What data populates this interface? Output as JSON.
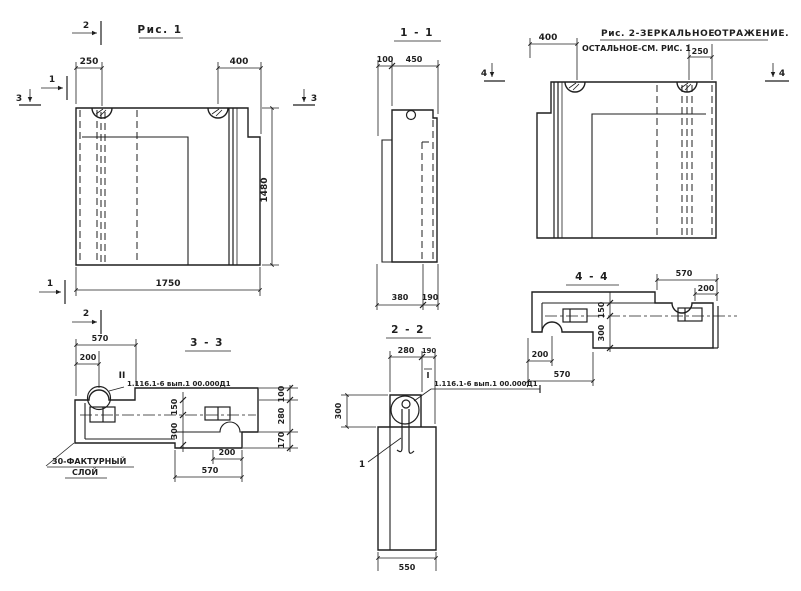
{
  "fig1": {
    "title": "Рис. 1",
    "dim_250": "250",
    "dim_400": "400",
    "dim_1480": "1480",
    "dim_1750": "1750"
  },
  "sec11": {
    "title": "1 - 1",
    "dim_100": "100",
    "dim_450": "450",
    "dim_380": "380",
    "dim_190": "190"
  },
  "fig2": {
    "title_a": "Рис. 2-ЗЕРКАЛЬНОЕ",
    "title_b": "ОТРАЖЕНИЕ.",
    "subtitle": "ОСТАЛЬНОЕ-СМ. РИС. 1",
    "dim_400": "400",
    "dim_250": "250"
  },
  "sec44": {
    "title": "4 - 4",
    "dim_570_top": "570",
    "dim_200_top": "200",
    "dim_150": "150",
    "dim_300": "300",
    "dim_200_bot": "200",
    "dim_570_bot": "570"
  },
  "sec33": {
    "title": "3 - 3",
    "dim_570_top": "570",
    "dim_200_top": "200",
    "dim_150": "150",
    "dim_300": "300",
    "dim_100": "100",
    "dim_280": "280",
    "dim_170": "170",
    "dim_200_bot": "200",
    "dim_570_bot": "570",
    "weld_mark": "II",
    "ref_label": "1.116.1-6 вып.1 00.000Д1",
    "note_line1": "30-ФАКТУРНЫЙ",
    "note_line2": "СЛОЙ"
  },
  "sec22": {
    "title": "2 - 2",
    "dim_280": "280",
    "dim_190": "190",
    "dim_300": "300",
    "dim_550": "550",
    "weld_mark": "I",
    "ref_label": "1.116.1-6 вып.1 00.000Д1",
    "item_label": "1"
  },
  "markers": {
    "m1": "1",
    "m2": "2",
    "m3": "3",
    "m4": "4"
  },
  "colors": {
    "ink": "#1f1f1f",
    "paper": "#ffffff"
  }
}
